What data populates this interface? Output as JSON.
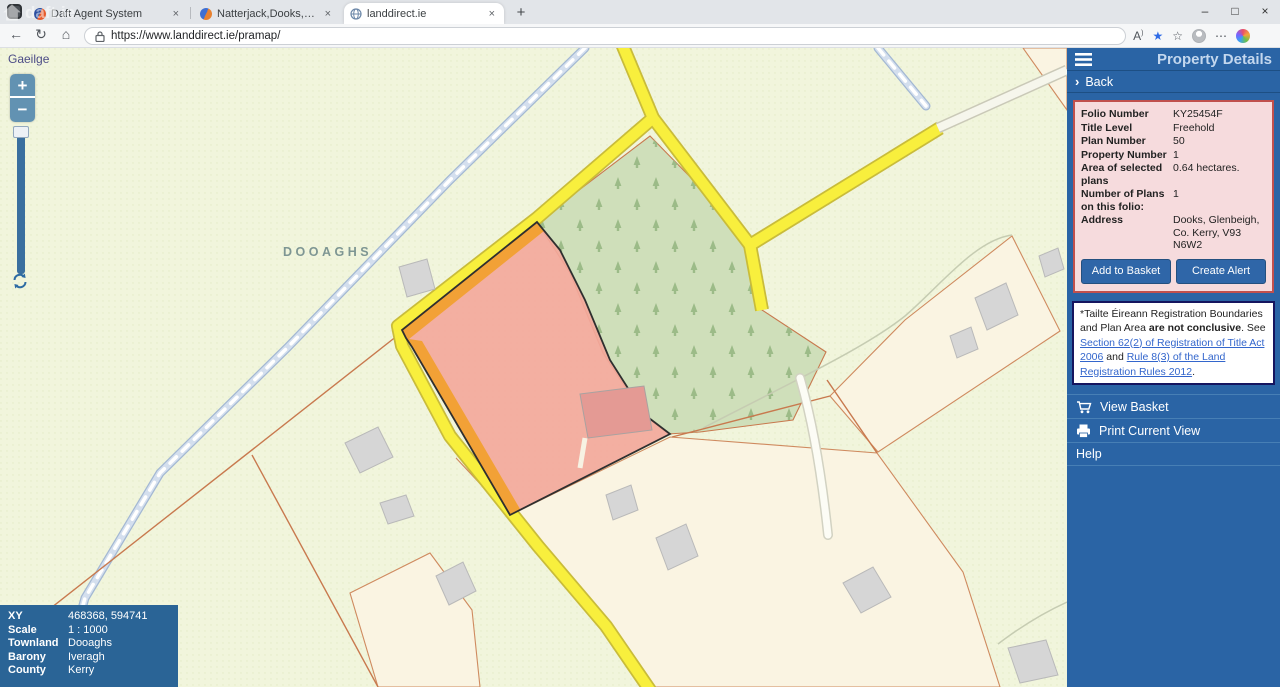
{
  "browser": {
    "tabs": [
      {
        "title": "Daft Agent System"
      },
      {
        "title": "Natterjack,Dooks, Glenbeigh, Co."
      },
      {
        "title": "landdirect.ie"
      }
    ],
    "new_tab_icon": "+",
    "close_icon": "×",
    "window_controls": {
      "minimize": "–",
      "maximize": "□",
      "close": "×"
    },
    "nav": {
      "back": "←",
      "refresh": "↻",
      "home": "⌂"
    },
    "address": {
      "url": "https://www.landdirect.ie/pramap/"
    },
    "toolbar_right": {
      "read_aloud": "A",
      "favorites_star": "★",
      "collections": "☆",
      "ellipsis": "⋯"
    },
    "watermark": "daft.ie"
  },
  "map": {
    "language_link": "Gaeilge",
    "area_label": "DOOAGHS",
    "controls": {
      "zoom_in": "+",
      "zoom_out": "−"
    },
    "info": {
      "rows": [
        {
          "label": "XY",
          "value": "468368, 594741"
        },
        {
          "label": "Scale",
          "value": "1 : 1000"
        },
        {
          "label": "Townland",
          "value": "Dooaghs"
        },
        {
          "label": "Barony",
          "value": "Iveragh"
        },
        {
          "label": "County",
          "value": "Kerry"
        }
      ]
    }
  },
  "panel": {
    "title": "Property Details",
    "back": {
      "chevron": "›",
      "label": "Back"
    },
    "details": {
      "rows": [
        {
          "label": "Folio Number",
          "value": "KY25454F"
        },
        {
          "label": "Title Level",
          "value": "Freehold"
        },
        {
          "label": "Plan Number",
          "value": "50"
        },
        {
          "label": "Property Number",
          "value": "1"
        },
        {
          "label": "Area of selected plans",
          "value": "0.64 hectares."
        },
        {
          "label": "Number of Plans on this folio:",
          "value": "1"
        },
        {
          "label": "Address",
          "value": "Dooks, Glenbeigh, Co. Kerry, V93 N6W2"
        }
      ],
      "buttons": {
        "add_to_basket": "Add to Basket",
        "create_alert": "Create Alert"
      }
    },
    "disclaimer": {
      "prefix": "*Tailte Éireann Registration Boundaries and Plan Area ",
      "bold": "are not conclusive",
      "mid": ". See ",
      "link1": "Section 62(2) of Registration of Title Act 2006",
      "and": " and ",
      "link2": "Rule 8(3) of the Land Registration Rules 2012",
      "suffix": "."
    },
    "menu": {
      "view_basket": "View Basket",
      "print": "Print Current View",
      "help": "Help"
    }
  },
  "colors": {
    "panel_blue": "#2a64a5",
    "info_box_blue": "#2a6496",
    "details_card_pink": "#f6dbdd",
    "details_card_border": "#c0504d",
    "selected_parcel_pink": "#f3a89b",
    "road_frontage_orange": "#f2a136",
    "road_yellow": "#f8ef3d",
    "forest_green": "#cfdfba",
    "boundary_sienna": "#c8794e",
    "map_background": "#f1f5dc"
  }
}
